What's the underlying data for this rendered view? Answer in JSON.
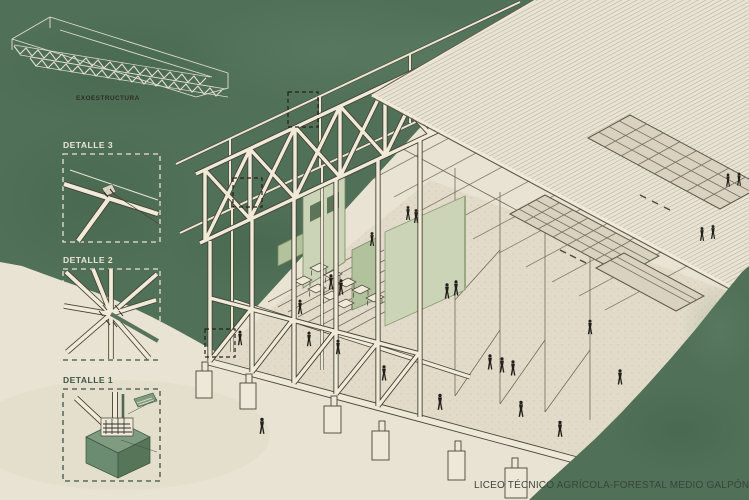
{
  "labels": {
    "exostructure": "EXOESTRUCTURA",
    "detail_3": "DETALLE 3",
    "detail_2": "DETALLE 2",
    "detail_1": "DETALLE 1"
  },
  "title": {
    "text": "LICEO TÉCNICO AGRÍCOLA-FORESTAL MEDIO GALPÓN"
  },
  "colors": {
    "canvas_green": "#507057",
    "green_shadow": "#3e5a46",
    "green_light": "#6d8f74",
    "paper_cream": "#e9e3d3",
    "floor_cream": "#e2dbc9",
    "beam_cream": "#f0ead9",
    "ink_dark": "#474135",
    "hatch_gray": "#b6afa0",
    "panel_light": "#cbd4b6",
    "panel_mid": "#b2c29c",
    "panel_window": "#5c7457",
    "detail_green": "#3c5541",
    "cube_green_top": "#7f9c81",
    "cube_green_left": "#6b8c70",
    "cube_green_right": "#577559",
    "figure_ink": "#221f1a",
    "label_light": "#ece6d6",
    "title_ink": "#3b433c"
  }
}
